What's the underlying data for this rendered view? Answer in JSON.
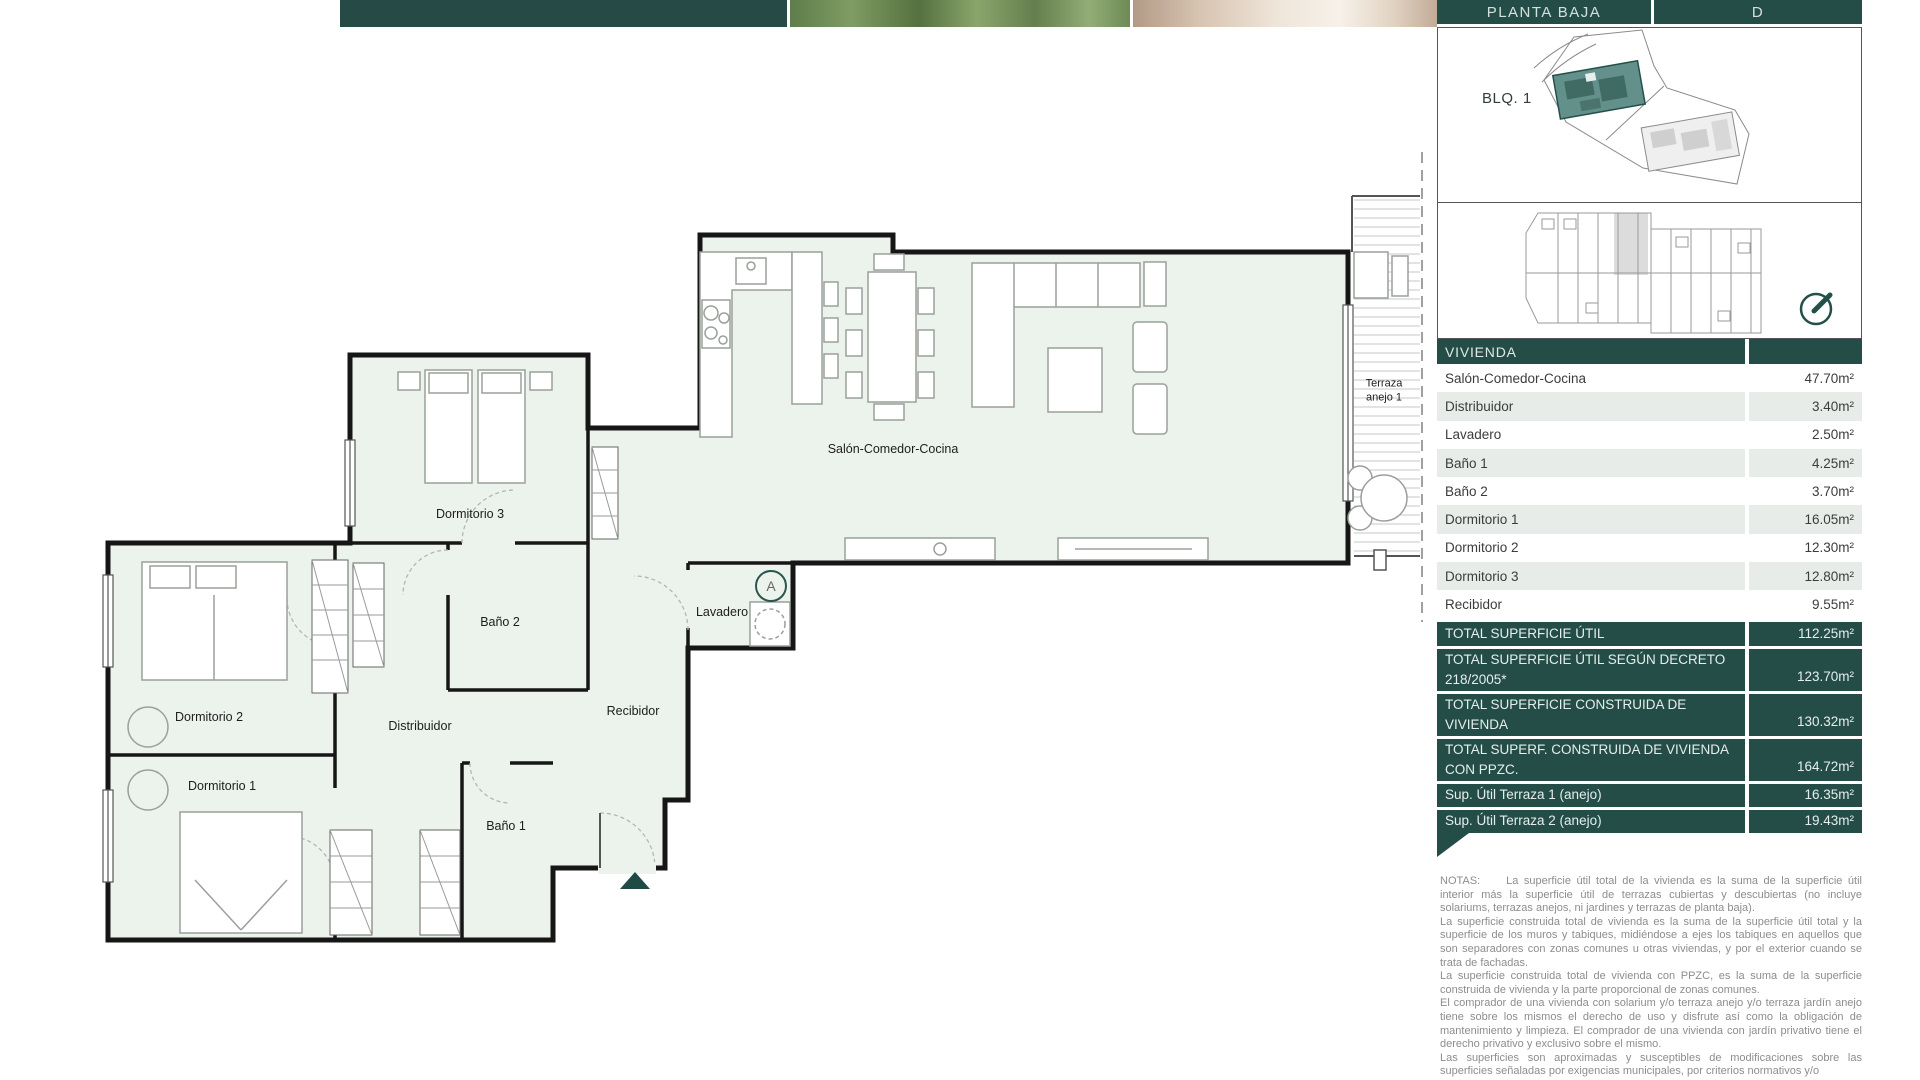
{
  "header": {
    "plan_level": "PLANTA BAJA",
    "unit_letter": "D"
  },
  "site_plan": {
    "block_label": "BLQ. 1"
  },
  "floor_plan": {
    "rooms": {
      "salon": "Salón-Comedor-Cocina",
      "dormitorio1": "Dormitorio 1",
      "dormitorio2": "Dormitorio 2",
      "dormitorio3": "Dormitorio 3",
      "bano1": "Baño 1",
      "bano2": "Baño 2",
      "distribuidor": "Distribuidor",
      "recibidor": "Recibidor",
      "lavadero": "Lavadero",
      "terraza": "Terraza anejo 1",
      "marker_a": "A"
    }
  },
  "table": {
    "header": "VIVIENDA",
    "rows": [
      {
        "label": "Salón-Comedor-Cocina",
        "value": "47.70m²"
      },
      {
        "label": "Distribuidor",
        "value": "3.40m²"
      },
      {
        "label": "Lavadero",
        "value": "2.50m²"
      },
      {
        "label": "Baño 1",
        "value": "4.25m²"
      },
      {
        "label": "Baño 2",
        "value": "3.70m²"
      },
      {
        "label": "Dormitorio 1",
        "value": "16.05m²"
      },
      {
        "label": "Dormitorio 2",
        "value": "12.30m²"
      },
      {
        "label": "Dormitorio 3",
        "value": "12.80m²"
      },
      {
        "label": "Recibidor",
        "value": "9.55m²"
      }
    ],
    "totals": [
      {
        "label": "TOTAL SUPERFICIE ÚTIL",
        "value": "112.25m²"
      },
      {
        "label": "TOTAL SUPERFICIE ÚTIL SEGÚN DECRETO 218/2005*",
        "value": "123.70m²"
      },
      {
        "label": "TOTAL SUPERFICIE CONSTRUIDA DE VIVIENDA",
        "value": "130.32m²"
      },
      {
        "label": "TOTAL SUPERF. CONSTRUIDA DE VIVIENDA CON PPZC.",
        "value": "164.72m²"
      }
    ],
    "annex": [
      {
        "label": "Sup. Útil Terraza 1 (anejo)",
        "value": "16.35m²"
      },
      {
        "label": "Sup. Útil Terraza 2 (anejo)",
        "value": "19.43m²"
      }
    ]
  },
  "notes": {
    "title": "NOTAS:",
    "paragraphs": [
      "La superficie útil total de la vivienda es la suma de la superficie útil interior más la superficie útil de terrazas cubiertas y descubiertas (no incluye solariums, terrazas anejos, ni jardines y terrazas de planta baja).",
      "La superficie construida total de vivienda es la suma de la superficie útil total y la superficie de los muros y tabiques, midiéndose a ejes los tabiques en aquellos que son separadores con zonas comunes u otras viviendas, y por el exterior cuando se trata de fachadas.",
      "La superficie construida total de vivienda con PPZC, es la suma de la superficie construida de vivienda y la parte proporcional de zonas comunes.",
      "El comprador de una vivienda con solarium y/o terraza anejo y/o terraza jardín anejo tiene sobre los mismos el derecho de uso y disfrute así como la obligación de mantenimiento y limpieza. El comprador de una vivienda con jardín privativo tiene el derecho privativo y exclusivo sobre el mismo.",
      "Las superficies son aproximadas y susceptibles de modificaciones sobre las superficies señaladas por exigencias municipales, por criterios normativos y/o"
    ]
  },
  "colors": {
    "teal": "#254d47",
    "row_alt": "#e8ece8",
    "plan_room": "#ecf3ec"
  }
}
